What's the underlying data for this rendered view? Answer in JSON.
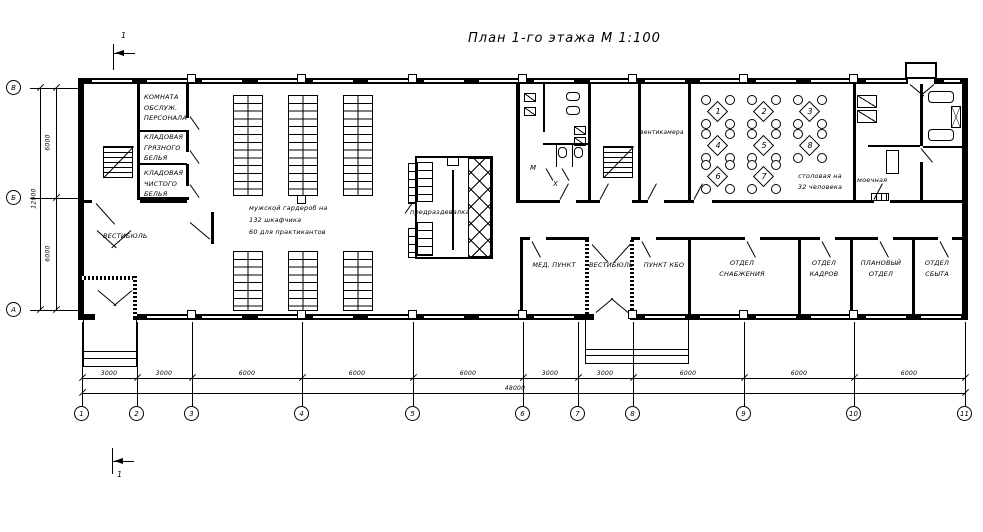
{
  "title": "План 1-го этажа М 1:100",
  "section_mark": "1",
  "axes": {
    "columns": [
      "1",
      "2",
      "3",
      "4",
      "5",
      "6",
      "7",
      "8",
      "9",
      "10",
      "11"
    ],
    "rows_top_to_bottom": [
      "В",
      "Б",
      "А"
    ]
  },
  "dimensions": {
    "horizontal_segments": [
      "3000",
      "3000",
      "6000",
      "6000",
      "6000",
      "3000",
      "3000",
      "6000",
      "6000",
      "6000"
    ],
    "horizontal_total": "48000",
    "vertical_segments": [
      "6000",
      "6000"
    ],
    "vertical_total": "12000"
  },
  "rooms": {
    "staff_room": "КОМНАТА\nОБСЛУЖ.\nПЕРСОНАЛА",
    "dirty_linen_storage": "КЛАДОВАЯ\nГРЯЗНОГО\nБЕЛЬЯ",
    "clean_linen_storage": "КЛАДОВАЯ\nЧИСТОГО\nБЕЛЬЯ",
    "vestibule_left": "ВЕСТИБЮЛЬ",
    "locker_room": "мужской гардероб на\n132 шкафчика\n60 для практикантов",
    "pre_changing_room": "предраздевалка",
    "toilet_men": "М",
    "toilet_x": "Х",
    "vent_chamber": "вентикамера",
    "dining_room": "столовая на\n32 человека",
    "washing_room": "моечная",
    "medical_point": "МЕД. ПУНКТ",
    "vestibule_right": "ВЕСТИБЮЛЬ",
    "consumer_services": "ПУНКТ КБО",
    "supply_department": "ОТДЕЛ\nСНАБЖЕНИЯ",
    "hr_department": "ОТДЕЛ\nКАДРОВ",
    "planning_department": "ПЛАНОВЫЙ\nОТДЕЛ",
    "sales_department": "ОТДЕЛ\nСБЫТА"
  },
  "dining_tables": [
    "1",
    "2",
    "3",
    "4",
    "5",
    "8",
    "6",
    "7"
  ],
  "colors": {
    "line": "#000000",
    "background": "#ffffff"
  }
}
